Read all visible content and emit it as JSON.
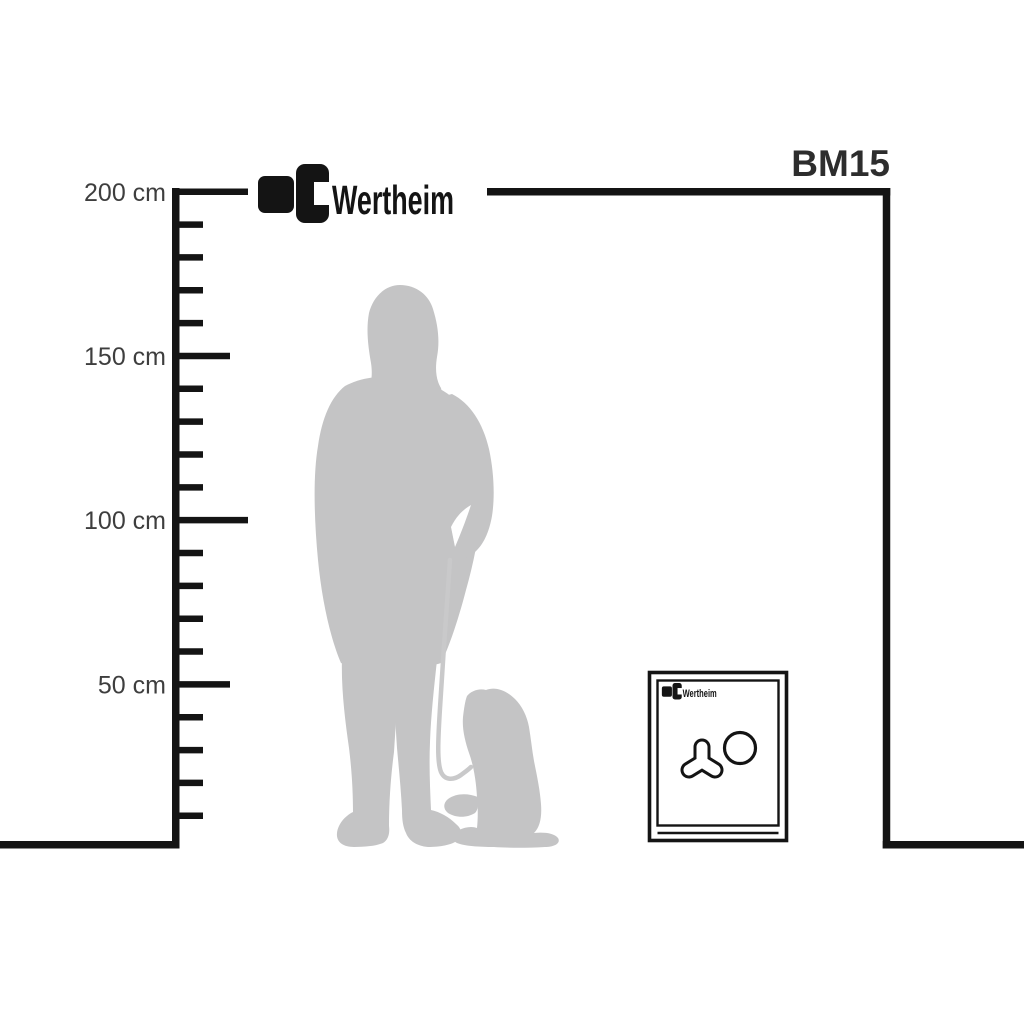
{
  "diagram": {
    "model_label": "BM15",
    "brand": "Wertheim",
    "background": "#ffffff"
  },
  "ruler": {
    "unit": "cm",
    "range_cm": [
      0,
      200
    ],
    "minor_step_cm": 10,
    "major_step_cm": 50,
    "labels": [
      {
        "cm": 200,
        "text": "200 cm"
      },
      {
        "cm": 150,
        "text": "150 cm"
      },
      {
        "cm": 100,
        "text": "100 cm"
      },
      {
        "cm": 50,
        "text": "50 cm"
      }
    ]
  },
  "colors": {
    "line": "#141414",
    "ruler_label_text": "#3e3e3e",
    "model_label_text": "#2d2d2d",
    "silhouette_gray": "#c4c4c5",
    "leash_gray": "#c9c9ca",
    "background": "#ffffff"
  },
  "figures": {
    "person": "standing-woman-silhouette",
    "dog": "sitting-dog-silhouette",
    "safe": "safe-front-view"
  }
}
